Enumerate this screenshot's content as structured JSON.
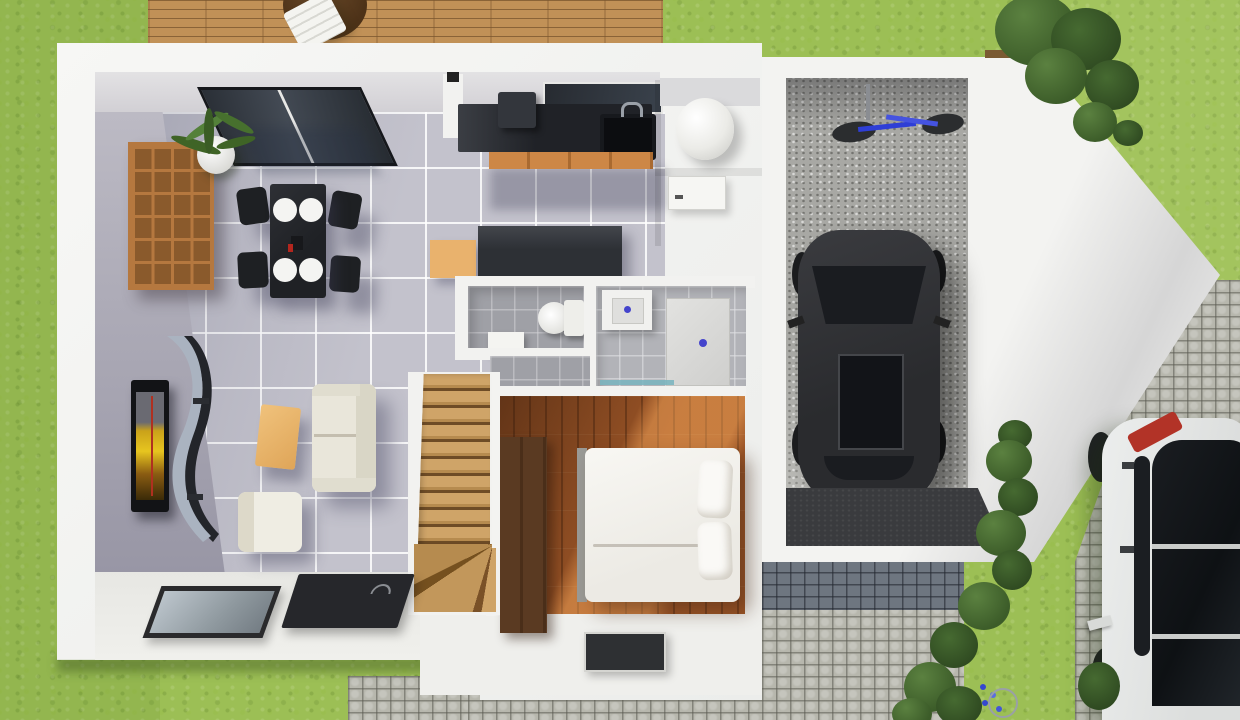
{
  "scene": {
    "title": "3D floor plan render",
    "description": "Top-down 3D architectural rendering of a house ground floor: living-dining room, kitchen, utility room, WC, shower room, bedroom, staircase, attached garage with parked dark car, wooden deck terrace, cobblestone driveway with white car, and surrounding lawn",
    "contains_text": false
  },
  "palette": {
    "lawn_green": "#9cbf55",
    "deck_wood": "#c19157",
    "wall_white": "#f2f2f0",
    "tile_floor": "#c3c2cc",
    "bathroom_tile": "#9fa0a6",
    "bedroom_wood": "#9c5527",
    "kitchen_counter_black": "#24262b",
    "cabinet_wood_orange": "#cd8746",
    "garage_concrete": "#a8a8a4",
    "cobblestone_light": "#b7b7ad",
    "cobblestone_blue_gray": "#6e7680",
    "hedge_green": "#3f612e",
    "garage_car_gray": "#2f3033",
    "parked_car_white": "#e2e4e3",
    "taillight_red": "#b23327",
    "bicycle_blue": "#2e3ed6",
    "tv_screen_amber": "#e7c51f"
  },
  "areas": {
    "lawn": {
      "name": "Garden lawn"
    },
    "deck": {
      "name": "Wooden deck terrace"
    },
    "living": {
      "name": "Living room"
    },
    "dining": {
      "name": "Dining area"
    },
    "kitchen": {
      "name": "Kitchen"
    },
    "utility": {
      "name": "Utility room"
    },
    "wc": {
      "name": "WC toilet room"
    },
    "shower": {
      "name": "Shower room"
    },
    "bedroom": {
      "name": "Bedroom"
    },
    "hall": {
      "name": "Entry hall"
    },
    "stairs": {
      "name": "Staircase"
    },
    "garage": {
      "name": "Garage"
    },
    "driveway": {
      "name": "Cobblestone driveway"
    },
    "path": {
      "name": "Cobblestone path"
    }
  },
  "objects": {
    "deck_table": {
      "name": "Round wooden deck table"
    },
    "deck_chair": {
      "name": "White folding deck chair"
    },
    "glass_door": {
      "name": "Sliding glass door"
    },
    "bookshelf": {
      "name": "Wooden cube bookshelf"
    },
    "plant": {
      "name": "Potted plant"
    },
    "dining_table": {
      "name": "Black dining table"
    },
    "dining_chair": {
      "name": "Black dining chair",
      "count": 4
    },
    "plate": {
      "name": "White place setting",
      "count": 4
    },
    "tv": {
      "name": "Wall-mounted TV"
    },
    "curved_shelf": {
      "name": "Curved designer wall shelf"
    },
    "coffee_table": {
      "name": "Wooden coffee table"
    },
    "sofa": {
      "name": "Cream two-seat sofa"
    },
    "armchair": {
      "name": "Cream armchair"
    },
    "floor_window": {
      "name": "Glass floor window"
    },
    "rug": {
      "name": "Dark area rug"
    },
    "kitchen_window": {
      "name": "Kitchen window"
    },
    "kitchen_counter": {
      "name": "Black kitchen counter"
    },
    "coffee_machine": {
      "name": "Countertop appliance"
    },
    "sink": {
      "name": "Kitchen sink"
    },
    "cabinets": {
      "name": "Wooden base cabinets"
    },
    "water_heater": {
      "name": "Cylindrical water heater"
    },
    "utility_door": {
      "name": "Utility room door"
    },
    "sideboard": {
      "name": "Dark sideboard"
    },
    "storage_box": {
      "name": "Wooden storage box"
    },
    "toilet": {
      "name": "Toilet"
    },
    "wc_basin": {
      "name": "Small washbasin"
    },
    "shower_sink": {
      "name": "Square washbasin"
    },
    "shower_tray": {
      "name": "Walk-in shower tray"
    },
    "shower_screen": {
      "name": "Glass shower screen"
    },
    "entrance_panel": {
      "name": "Framed glass floor panel"
    },
    "wardrobe": {
      "name": "Dark wood wardrobe"
    },
    "bed": {
      "name": "Double bed"
    },
    "pillow": {
      "name": "Pillow",
      "count": 2
    },
    "doormat": {
      "name": "Entry doormat"
    },
    "staircase": {
      "name": "Wooden staircase with winders"
    },
    "garage_car": {
      "name": "Dark gray car"
    },
    "bicycle": {
      "name": "Blue bicycle"
    },
    "garage_mat": {
      "name": "Dark garage threshold mat"
    },
    "bush_large": {
      "name": "Large garden bush"
    },
    "hedge": {
      "name": "Hedge along garage wall"
    },
    "flowers": {
      "name": "Blue flowers"
    },
    "parked_car": {
      "name": "White parked car"
    }
  }
}
